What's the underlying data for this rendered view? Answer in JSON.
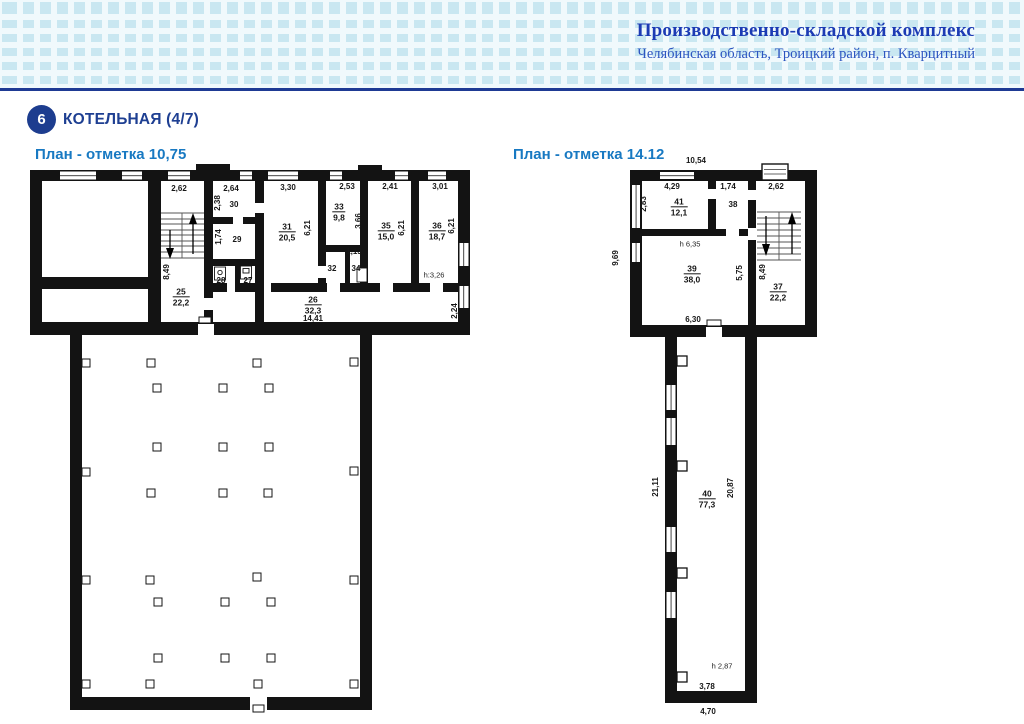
{
  "header": {
    "title": "Производственно-складской комплекс",
    "subtitle": "Челябинская область, Троицкий район, п. Кварцитный"
  },
  "section": {
    "number": "6",
    "title": "КОТЕЛЬНАЯ (4/7)"
  },
  "colors": {
    "banner_bg": "#f0f9fc",
    "banner_square": "#c9e7f1",
    "rule_navy": "#1e3a94",
    "badge_navy": "#1d3d8f",
    "section_navy": "#1e3f92",
    "plan_title_blue": "#1879c2",
    "header_blue": "#1c3bb4",
    "header_subtitle_blue": "#2c55c0",
    "ink": "#161616",
    "wall": "#131313"
  },
  "plan_left": {
    "title": "План - отметка 10,75",
    "labels": [
      {
        "t": "2,62",
        "x": 179,
        "y": 189
      },
      {
        "t": "2,64",
        "x": 231,
        "y": 189
      },
      {
        "t": "3,30",
        "x": 288,
        "y": 188
      },
      {
        "t": "2,53",
        "x": 347,
        "y": 187
      },
      {
        "t": "2,41",
        "x": 390,
        "y": 187
      },
      {
        "t": "3,01",
        "x": 440,
        "y": 187
      },
      {
        "t": "2,38",
        "x": 218,
        "y": 203,
        "rot": 1
      },
      {
        "t": "30",
        "x": 234,
        "y": 205
      },
      {
        "t": "1,74",
        "x": 219,
        "y": 237,
        "rot": 1
      },
      {
        "t": "29",
        "x": 237,
        "y": 240
      },
      {
        "t": "8,49",
        "x": 167,
        "y": 272,
        "rot": 1
      },
      {
        "t": "28",
        "x": 221,
        "y": 281
      },
      {
        "t": "27",
        "x": 248,
        "y": 281
      },
      {
        "num": "25",
        "area": "22,2",
        "x": 181,
        "y": 297
      },
      {
        "num": "31",
        "area": "20,5",
        "x": 287,
        "y": 232
      },
      {
        "t": "6,21",
        "x": 308,
        "y": 228,
        "rot": 1
      },
      {
        "num": "33",
        "area": "9,8",
        "x": 339,
        "y": 212
      },
      {
        "t": "3,66",
        "x": 359,
        "y": 221,
        "rot": 1
      },
      {
        "t": "32",
        "x": 332,
        "y": 269
      },
      {
        "t": "1,13",
        "x": 354,
        "y": 252
      },
      {
        "t": "34",
        "x": 356,
        "y": 269
      },
      {
        "num": "35",
        "area": "15,0",
        "x": 386,
        "y": 231
      },
      {
        "t": "6,21",
        "x": 402,
        "y": 228,
        "rot": 1
      },
      {
        "num": "36",
        "area": "18,7",
        "x": 437,
        "y": 231
      },
      {
        "t": "6,21",
        "x": 452,
        "y": 226,
        "rot": 1
      },
      {
        "t": "h:3,26",
        "x": 434,
        "y": 275,
        "h": 1
      },
      {
        "num": "26",
        "area": "32,3",
        "x": 313,
        "y": 305
      },
      {
        "t": "14,41",
        "x": 313,
        "y": 319
      },
      {
        "t": "2,24",
        "x": 455,
        "y": 311,
        "rot": 1
      }
    ],
    "columns": [
      {
        "x": 86,
        "y": 363
      },
      {
        "x": 151,
        "y": 363
      },
      {
        "x": 257,
        "y": 363
      },
      {
        "x": 354,
        "y": 362
      },
      {
        "x": 157,
        "y": 388
      },
      {
        "x": 223,
        "y": 388
      },
      {
        "x": 269,
        "y": 388
      },
      {
        "x": 157,
        "y": 447
      },
      {
        "x": 223,
        "y": 447
      },
      {
        "x": 269,
        "y": 447
      },
      {
        "x": 86,
        "y": 472
      },
      {
        "x": 354,
        "y": 471
      },
      {
        "x": 151,
        "y": 493
      },
      {
        "x": 223,
        "y": 493
      },
      {
        "x": 268,
        "y": 493
      },
      {
        "x": 86,
        "y": 580
      },
      {
        "x": 150,
        "y": 580
      },
      {
        "x": 257,
        "y": 577
      },
      {
        "x": 354,
        "y": 580
      },
      {
        "x": 158,
        "y": 602
      },
      {
        "x": 225,
        "y": 602
      },
      {
        "x": 271,
        "y": 602
      },
      {
        "x": 158,
        "y": 658
      },
      {
        "x": 225,
        "y": 658
      },
      {
        "x": 271,
        "y": 658
      },
      {
        "x": 86,
        "y": 684
      },
      {
        "x": 150,
        "y": 684
      },
      {
        "x": 258,
        "y": 684
      },
      {
        "x": 354,
        "y": 684
      }
    ]
  },
  "plan_right": {
    "title": "План - отметка 14.12",
    "labels": [
      {
        "t": "10,54",
        "x": 696,
        "y": 161
      },
      {
        "t": "4,29",
        "x": 672,
        "y": 187
      },
      {
        "t": "1,74",
        "x": 728,
        "y": 187
      },
      {
        "t": "2,62",
        "x": 776,
        "y": 187
      },
      {
        "t": "2,83",
        "x": 644,
        "y": 204,
        "rot": 1
      },
      {
        "num": "41",
        "area": "12,1",
        "x": 679,
        "y": 207
      },
      {
        "t": "38",
        "x": 733,
        "y": 205
      },
      {
        "t": "h 6,35",
        "x": 690,
        "y": 244,
        "h": 1
      },
      {
        "num": "39",
        "area": "38,0",
        "x": 692,
        "y": 274
      },
      {
        "t": "5,75",
        "x": 740,
        "y": 273,
        "rot": 1
      },
      {
        "t": "8,49",
        "x": 763,
        "y": 272,
        "rot": 1
      },
      {
        "num": "37",
        "area": "22,2",
        "x": 778,
        "y": 292
      },
      {
        "t": "9,69",
        "x": 616,
        "y": 258,
        "rot": 1
      },
      {
        "t": "6,30",
        "x": 693,
        "y": 320
      },
      {
        "t": "21,11",
        "x": 656,
        "y": 487,
        "rot": 1
      },
      {
        "num": "40",
        "area": "77,3",
        "x": 707,
        "y": 499
      },
      {
        "t": "20,87",
        "x": 731,
        "y": 488,
        "rot": 1
      },
      {
        "t": "h 2,87",
        "x": 722,
        "y": 666,
        "h": 1
      },
      {
        "t": "3,78",
        "x": 707,
        "y": 687
      },
      {
        "t": "4,70",
        "x": 708,
        "y": 712
      }
    ]
  }
}
